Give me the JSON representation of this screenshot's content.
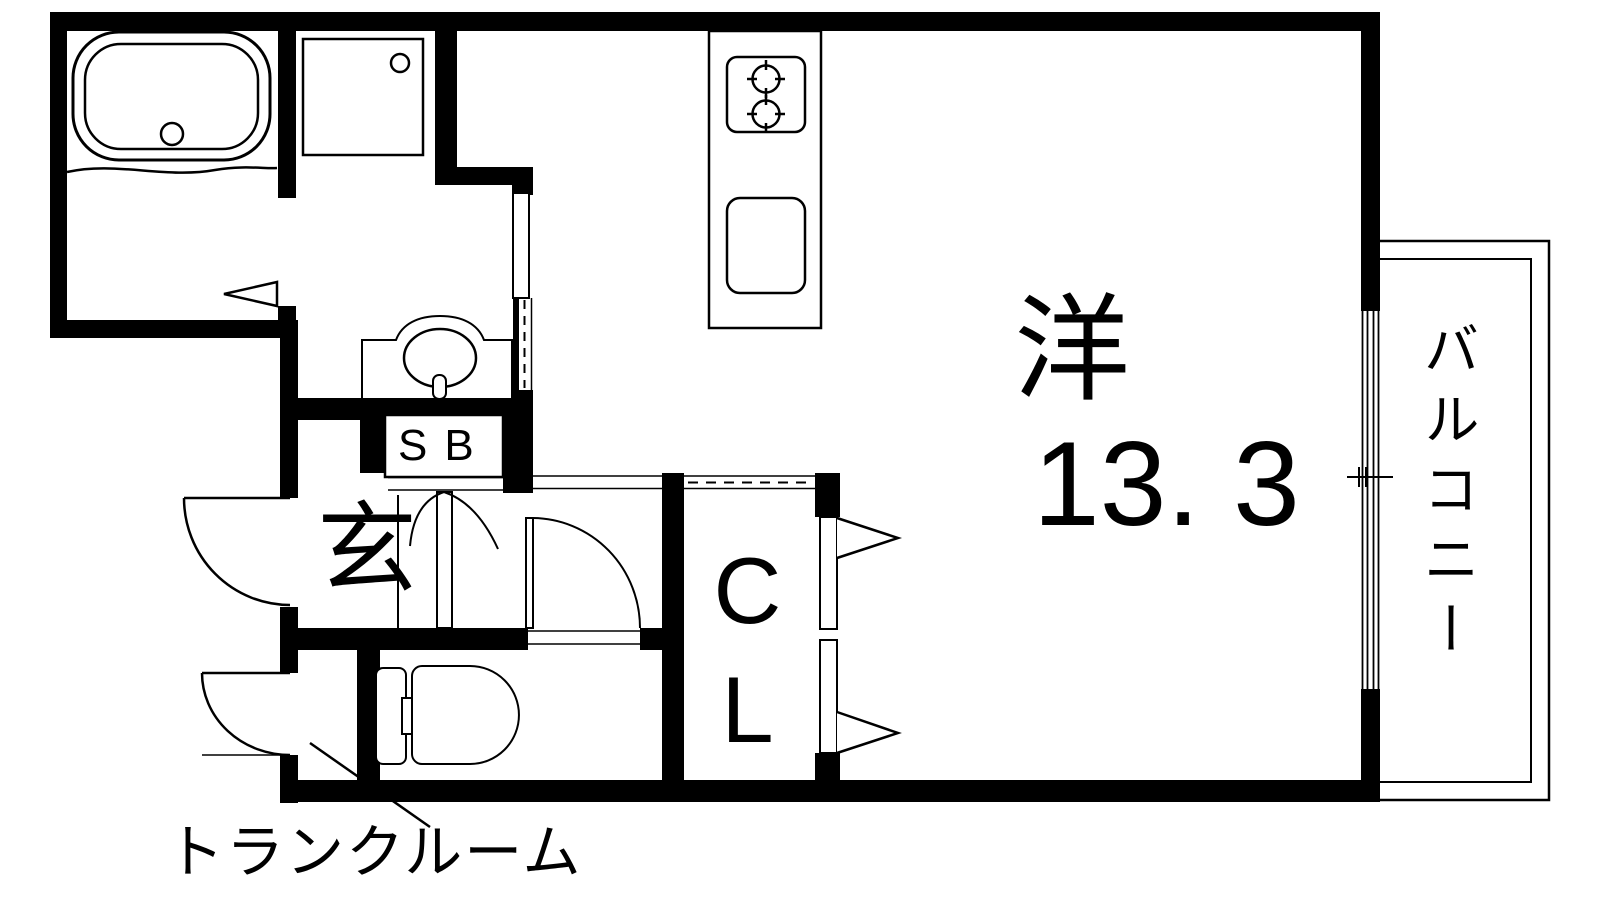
{
  "colors": {
    "line": "#000000",
    "background": "#ffffff"
  },
  "rooms": {
    "main_room": {
      "label": "洋",
      "area": "13. 3"
    },
    "balcony": {
      "label": "バルコニー"
    },
    "entrance": {
      "label": "玄"
    },
    "shoe_box": {
      "label": "SB"
    },
    "closet": {
      "label": "CL"
    },
    "trunk_room": {
      "label": "トランクルーム"
    }
  }
}
